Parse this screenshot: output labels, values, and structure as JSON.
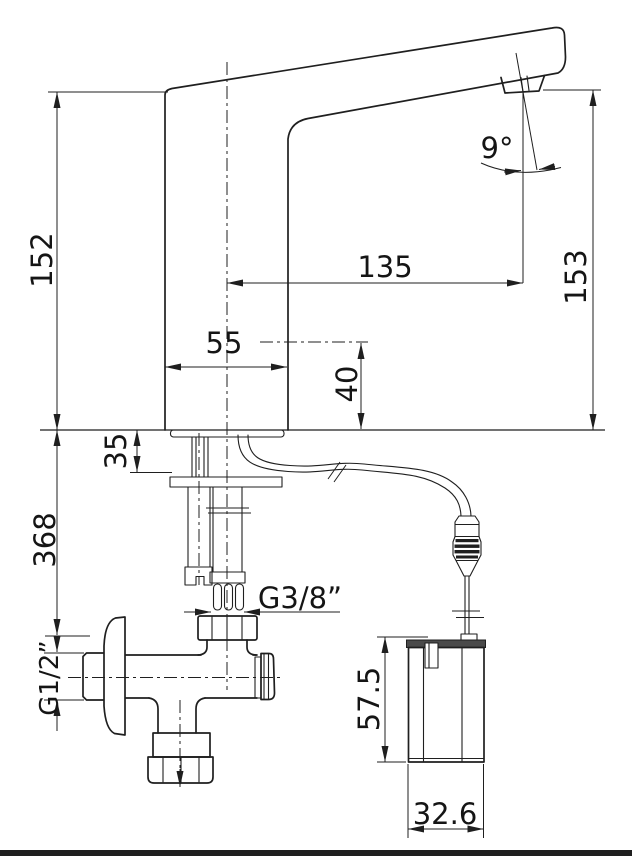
{
  "drawing": {
    "type": "technical dimension drawing",
    "subject": "automatic sensor basin faucet with control box and angle valve",
    "line_color": "#1f1f1f",
    "background_color": "#ffffff"
  },
  "dims": {
    "spout_height": "152",
    "spout_reach": "135",
    "outlet_height": "153",
    "body_depth": "55",
    "sensor_height": "40",
    "max_deck_thickness": "35",
    "under_counter_length": "368",
    "hose_thread": "G3/8”",
    "valve_thread": "G1/2”",
    "spray_angle": "9°",
    "control_box_height": "57.5",
    "control_box_width": "32.6"
  }
}
